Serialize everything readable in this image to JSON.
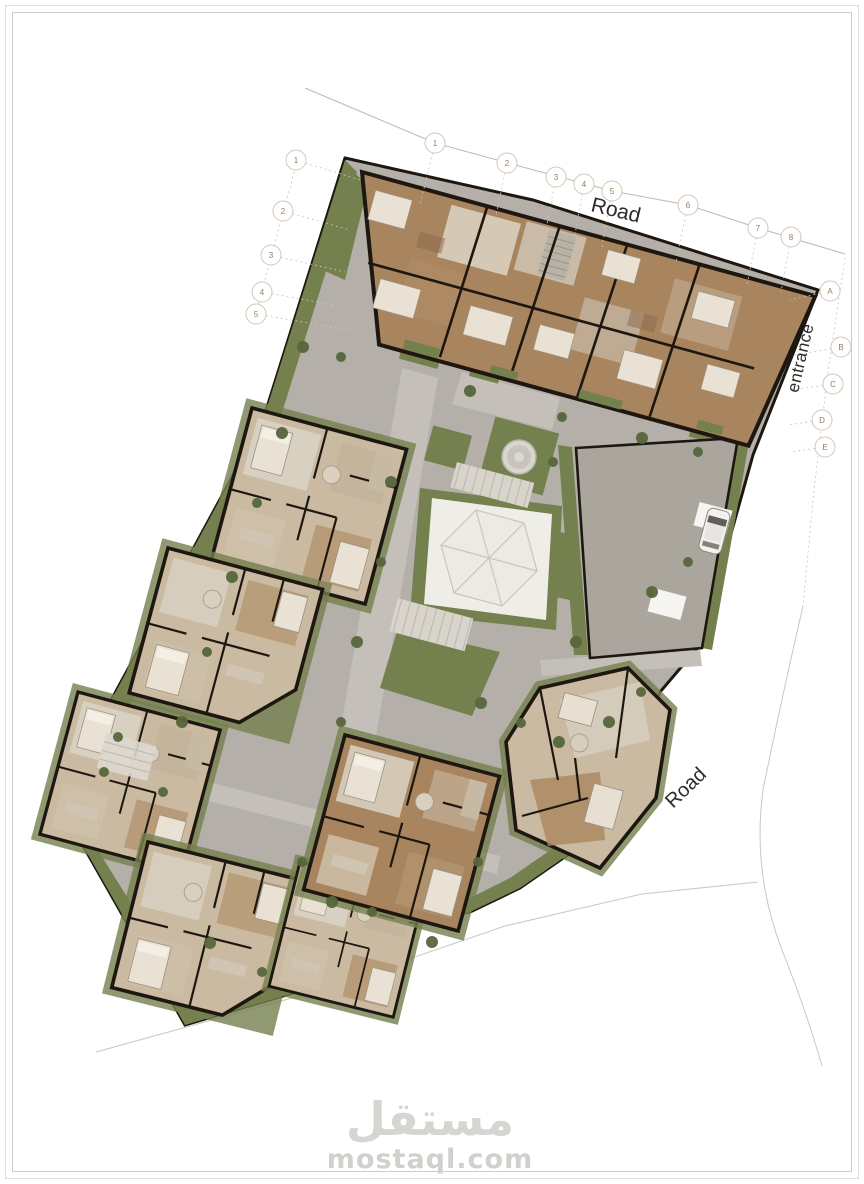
{
  "labels": {
    "road_top": "Road",
    "entrance": "entrance",
    "road_bottom": "Road"
  },
  "watermark": {
    "arabic": "مستقل",
    "latin": "mostaql.com"
  },
  "grid": {
    "top": [
      "1",
      "2",
      "3",
      "4",
      "5",
      "6",
      "7",
      "8"
    ],
    "left": [
      "1",
      "2",
      "3",
      "4",
      "5"
    ],
    "right": [
      "A",
      "B",
      "C",
      "D",
      "E"
    ]
  },
  "theme": {
    "paving": "#b4b0a9",
    "paving_light": "#c4c0b9",
    "green": "#75804f",
    "green_dark": "#57663c",
    "floor_tan": "#cabaa2",
    "floor_wood": "#a8845f",
    "wall": "#1d1710",
    "line": "#c4b8a6",
    "line_gray": "#cbc7c0",
    "bubble": "#9a7a58",
    "label": "#2e2c29",
    "watermark": "#d7d5d2"
  }
}
